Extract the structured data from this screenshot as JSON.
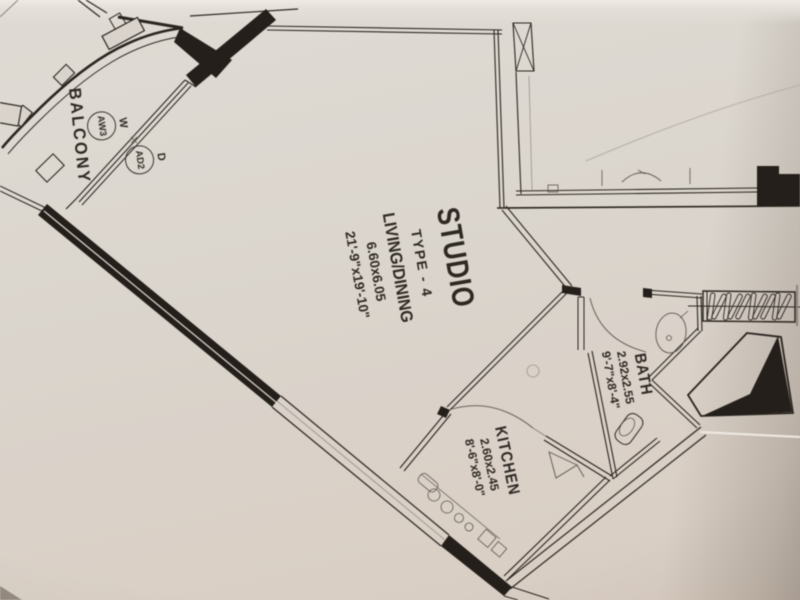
{
  "palette": {
    "paper": "#d9d3cb",
    "ink": "#241f1a",
    "faint": "#5d564e",
    "text": "#2e2823"
  },
  "unit": {
    "name": "STUDIO",
    "type": "TYPE - 4",
    "area_label": "LIVING/DINING",
    "area_dims_m": "6.60x6.05",
    "area_dims_ft": "21'-9\"x19'-10\""
  },
  "rooms": {
    "balcony": {
      "label": "BALCONY"
    },
    "bath": {
      "label": "BATH",
      "dims_m": "2.92x2.55",
      "dims_ft": "9'-7\"x8'-4\""
    },
    "kitchen": {
      "label": "KITCHEN",
      "dims_m": "2.60x2.45",
      "dims_ft": "8'-6\"x8'-0\""
    }
  },
  "openings": {
    "window": {
      "tag": "W",
      "code": "AW3"
    },
    "door": {
      "tag": "D",
      "code": "AD2"
    }
  }
}
